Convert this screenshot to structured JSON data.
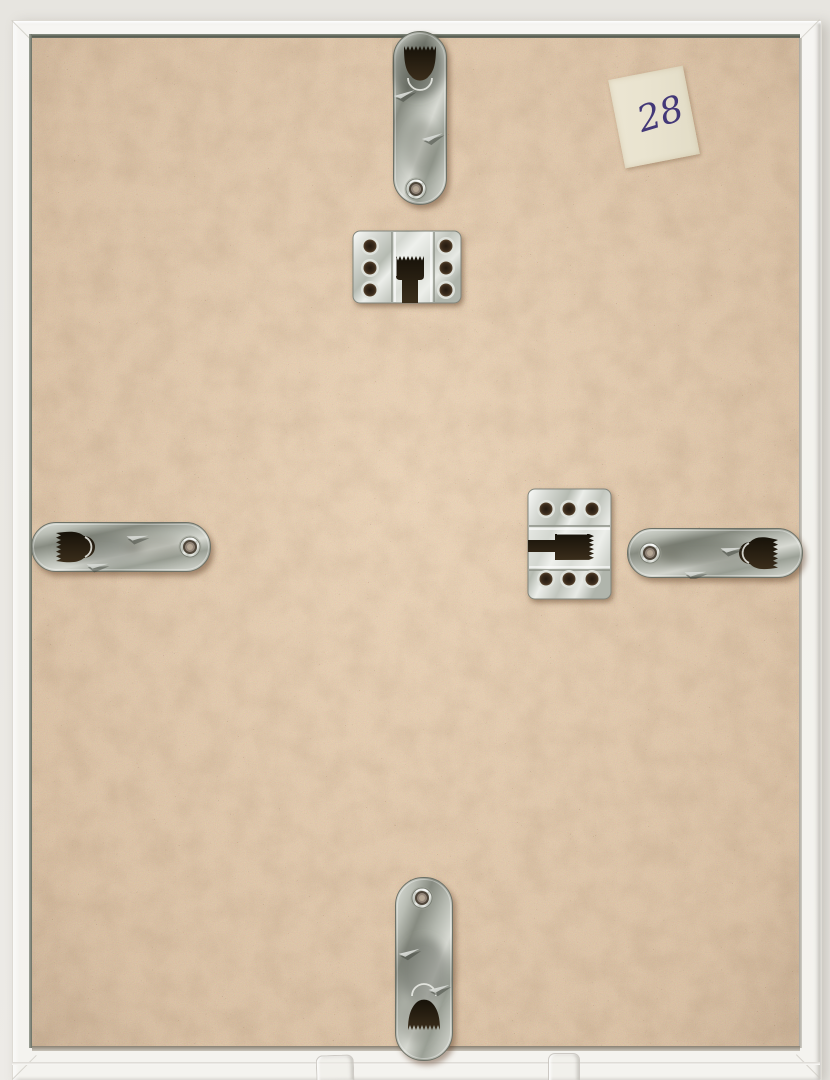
{
  "label": {
    "text": "28",
    "ink_color": "#433878",
    "tape_color": "#eae4d1"
  },
  "frame": {
    "wall_color": "#e8e6e1",
    "frame_color": "#f2f1ec",
    "backing_color": "#c89b6f",
    "glass_edge_color": "#5d6356"
  },
  "hardware": {
    "metal_color": "#c6c9c1",
    "items": [
      {
        "name": "keyhole-strap-hanger-top",
        "orientation": "vertical"
      },
      {
        "name": "sawtooth-plate-hanger-upper",
        "orientation": "vertical"
      },
      {
        "name": "keyhole-strap-hanger-left",
        "orientation": "horizontal"
      },
      {
        "name": "sawtooth-plate-hanger-right",
        "orientation": "horizontal"
      },
      {
        "name": "keyhole-strap-hanger-right",
        "orientation": "horizontal"
      },
      {
        "name": "keyhole-strap-hanger-bottom",
        "orientation": "vertical"
      }
    ]
  },
  "stand": {
    "name": "acrylic-easel-prongs",
    "count": 2
  }
}
